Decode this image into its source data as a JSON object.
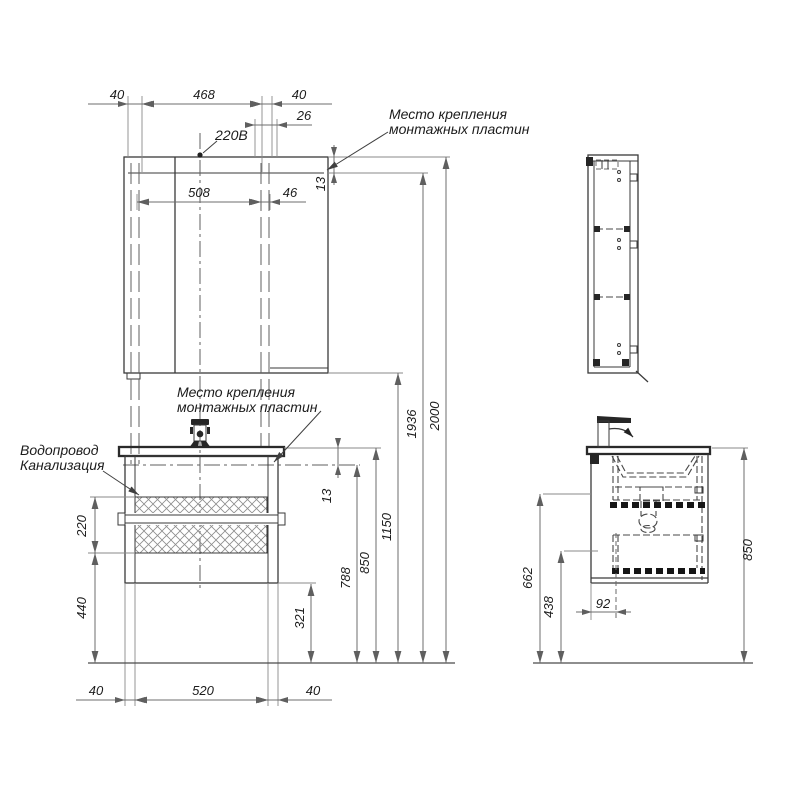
{
  "drawing": {
    "notes": {
      "power_label": "220В",
      "water_label": "Водопровод",
      "sewer_label": "Канализация",
      "mount_note_top": {
        "line1": "Место крепления",
        "line2": "монтажных пластин"
      },
      "mount_note_mid": {
        "line1": "Место крепления",
        "line2": "монтажных пластин"
      }
    },
    "front_view": {
      "dims": {
        "top_40_left": "40",
        "top_468": "468",
        "top_40_right": "40",
        "top_26": "26",
        "mirror_13": "13",
        "mirror_508": "508",
        "mirror_46": "46",
        "h_2000": "2000",
        "h_1936": "1936",
        "h_1150": "1150",
        "h_850": "850",
        "h_788": "788",
        "counter_13": "13",
        "h_321": "321",
        "zone_220": "220",
        "zone_440": "440",
        "bottom_40_left": "40",
        "bottom_520": "520",
        "bottom_40_right": "40"
      }
    },
    "side_view": {
      "dims": {
        "d_662": "662",
        "d_438": "438",
        "d_92": "92",
        "d_850": "850"
      }
    },
    "line_colors": {
      "outline": "#3a3a3a",
      "dimension": "#6e6e6e",
      "text": "#1c1c1c"
    }
  }
}
